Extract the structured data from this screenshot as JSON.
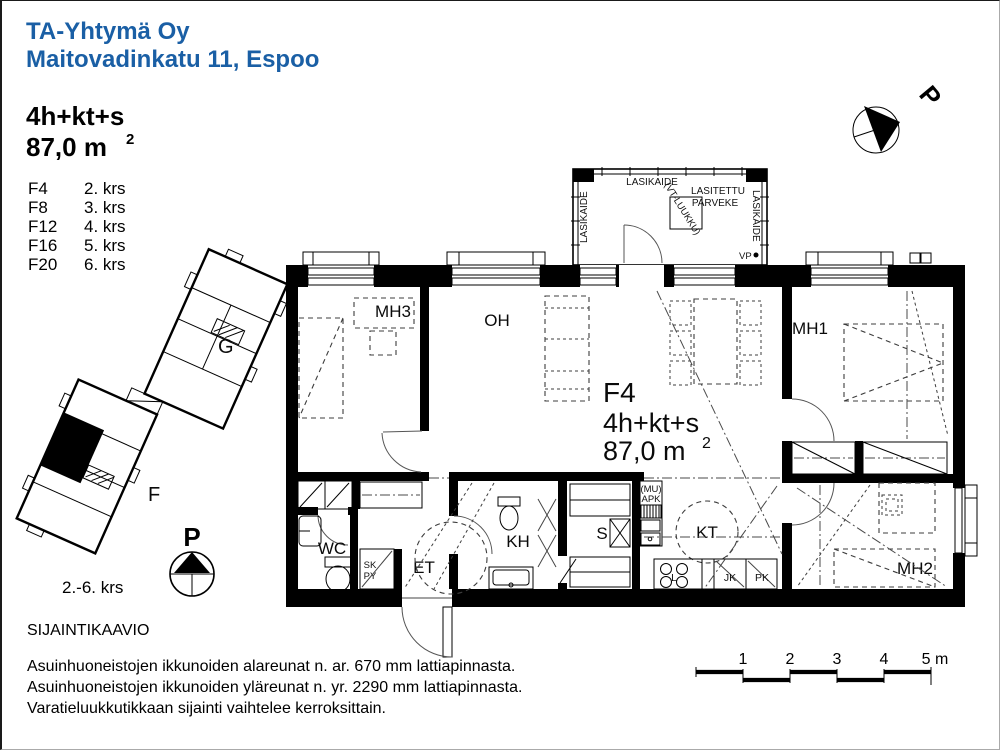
{
  "header": {
    "company": "TA-Yhtymä Oy",
    "address": "Maitovadinkatu 11, Espoo"
  },
  "summary": {
    "type": "4h+kt+s",
    "area": "87,0 m",
    "area_sup": "2"
  },
  "floors": [
    {
      "unit": "F4",
      "floor": "2. krs"
    },
    {
      "unit": "F8",
      "floor": "3. krs"
    },
    {
      "unit": "F12",
      "floor": "4. krs"
    },
    {
      "unit": "F16",
      "floor": "5. krs"
    },
    {
      "unit": "F20",
      "floor": "6. krs"
    }
  ],
  "site": {
    "building_g": "G",
    "building_f": "F",
    "floors_range": "2.-6. krs",
    "compass_label": "P",
    "caption": "SIJAINTIKAAVIO"
  },
  "plan": {
    "unit": "F4",
    "type": "4h+kt+s",
    "area": "87,0 m",
    "area_sup": "2",
    "north_label": "P",
    "rooms": {
      "mh3": "MH3",
      "oh": "OH",
      "mh1": "MH1",
      "mh2": "MH2",
      "wc": "WC",
      "et": "ET",
      "kh": "KH",
      "s": "S",
      "kt": "KT"
    },
    "labels": {
      "sk": "SK",
      "py": "PY",
      "mu": "(MU)",
      "apk": "APK",
      "l": "L",
      "jk": "JK",
      "pk": "PK",
      "vp": "VP"
    },
    "balcony": {
      "rail_left": "LASIKAIDE",
      "rail_top": "LASIKAIDE",
      "rail_right": "LASIKAIDE",
      "glazed_1": "LASITETTU",
      "glazed_2": "PARVEKE",
      "hatch": "(VT-LUUKKU)"
    }
  },
  "notes": [
    "Asuinhuoneistojen ikkunoiden alareunat n. ar. 670 mm lattiapinnasta.",
    "Asuinhuoneistojen ikkunoiden yläreunat n. yr. 2290 mm lattiapinnasta.",
    "Varatieluukkutikkaan sijainti vaihtelee kerroksittain."
  ],
  "scalebar": {
    "t1": "1",
    "t2": "2",
    "t3": "3",
    "t4": "4",
    "t5": "5 m"
  }
}
